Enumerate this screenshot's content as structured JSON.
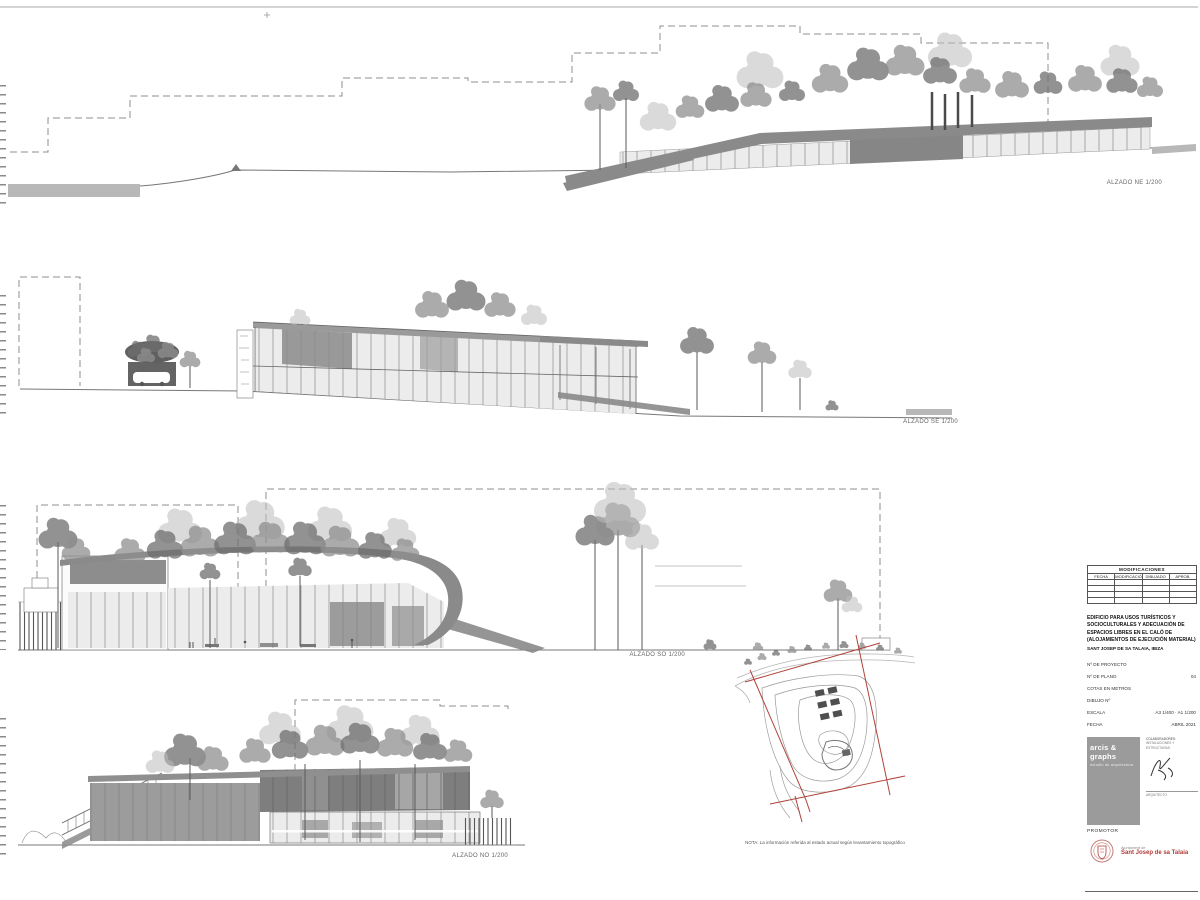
{
  "sheet": {
    "elevation_labels": {
      "ne": "ALZADO NE 1/200",
      "se": "ALZADO SE 1/200",
      "so": "ALZADO SO 1/200",
      "no": "ALZADO NO 1/200"
    },
    "site_plan_note": "NOTA: La información referida al estado actual según levantamiento topográfico"
  },
  "title_block": {
    "revisions_table": {
      "title": "MODIFICACIONES",
      "columns": [
        "FECHA",
        "MODIFICACIÓN",
        "DIBUJADO",
        "APROB."
      ]
    },
    "project_title": "EDIFICIO PARA USOS TURÍSTICOS Y SOCIOCULTURALES Y ADECUACIÓN DE ESPACIOS LIBRES EN EL CALÓ DE (ALOJAMIENTOS DE EJECUCIÓN MATERIAL)",
    "project_location": "SANT JOSEP DE SA TALAIA, IBIZA",
    "fields": [
      {
        "label": "Nº DE PROYECTO",
        "value": ""
      },
      {
        "label": "Nº DE PLANO",
        "value": "04"
      },
      {
        "label": "COTAS EN METROS",
        "value": ""
      },
      {
        "label": "DIBUJO Nº",
        "value": ""
      },
      {
        "label": "ESCALA",
        "value": "A3 1/400 · A1 1/200"
      },
      {
        "label": "FECHA",
        "value": "ABRIL 2021"
      }
    ],
    "logo": {
      "name": "arcis & graphs",
      "tagline": "estudio de arquitectura"
    },
    "collaborators_label": "COLABORADORES:",
    "collaborators_note": "instalaciones y estructuras",
    "signature_note": "arquitecto",
    "promoter_label": "PROMOTOR",
    "promoter_name_line1": "Ajuntament de",
    "promoter_name_line2": "Sant Josep de sa Talaia"
  },
  "colors": {
    "band_gray": "#8a8a8a",
    "site_red": "#b0433a",
    "seal_red": "#b23a36"
  }
}
